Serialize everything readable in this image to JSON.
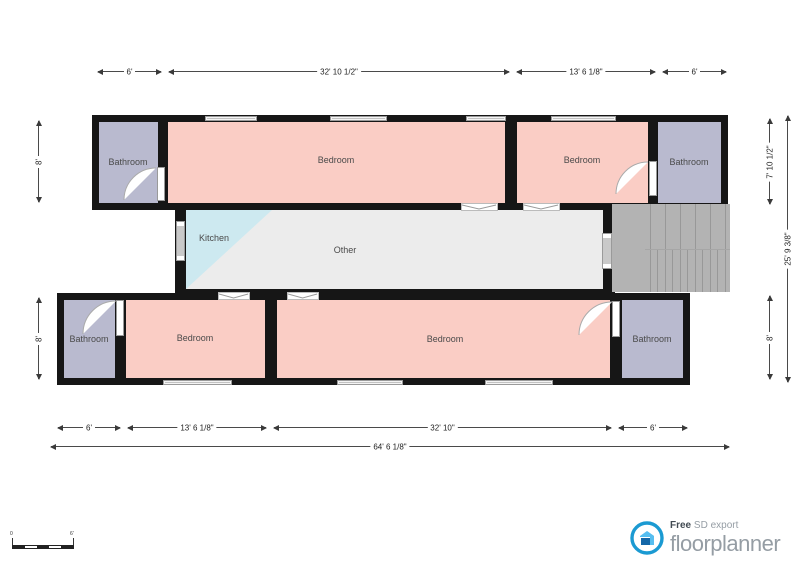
{
  "plan": {
    "rooms": {
      "bathroom_tl": "Bathroom",
      "bedroom_tl": "Bedroom",
      "bedroom_tr": "Bedroom",
      "bathroom_tr": "Bathroom",
      "kitchen": "Kitchen",
      "other": "Other",
      "bathroom_bl": "Bathroom",
      "bedroom_bl": "Bedroom",
      "bedroom_br": "Bedroom",
      "bathroom_br": "Bathroom"
    },
    "colors": {
      "wall": "#161616",
      "bathroom_fill": "#b9bacf",
      "bedroom_fill": "#facdc5",
      "kitchen_fill": "#cde9f0",
      "other_fill": "#ececec",
      "stairs_fill": "#b3b3b3"
    }
  },
  "dimensions": {
    "top": [
      "6'",
      "32' 10 1/2\"",
      "13' 6 1/8\"",
      "6'"
    ],
    "bottom": [
      "6'",
      "13' 6 1/8\"",
      "32' 10\"",
      "6'"
    ],
    "bottom_overall": "64' 6 1/8\"",
    "left": [
      "8'",
      "8'"
    ],
    "right": [
      "7' 10 1/2\"",
      "8'"
    ],
    "right_overall": "25' 9 3/8\""
  },
  "scale_bar": {
    "start": "0",
    "end": "6'"
  },
  "branding": {
    "free": "Free",
    "export": "SD export",
    "name": "floorplanner",
    "accent": "#1b9ad2"
  }
}
